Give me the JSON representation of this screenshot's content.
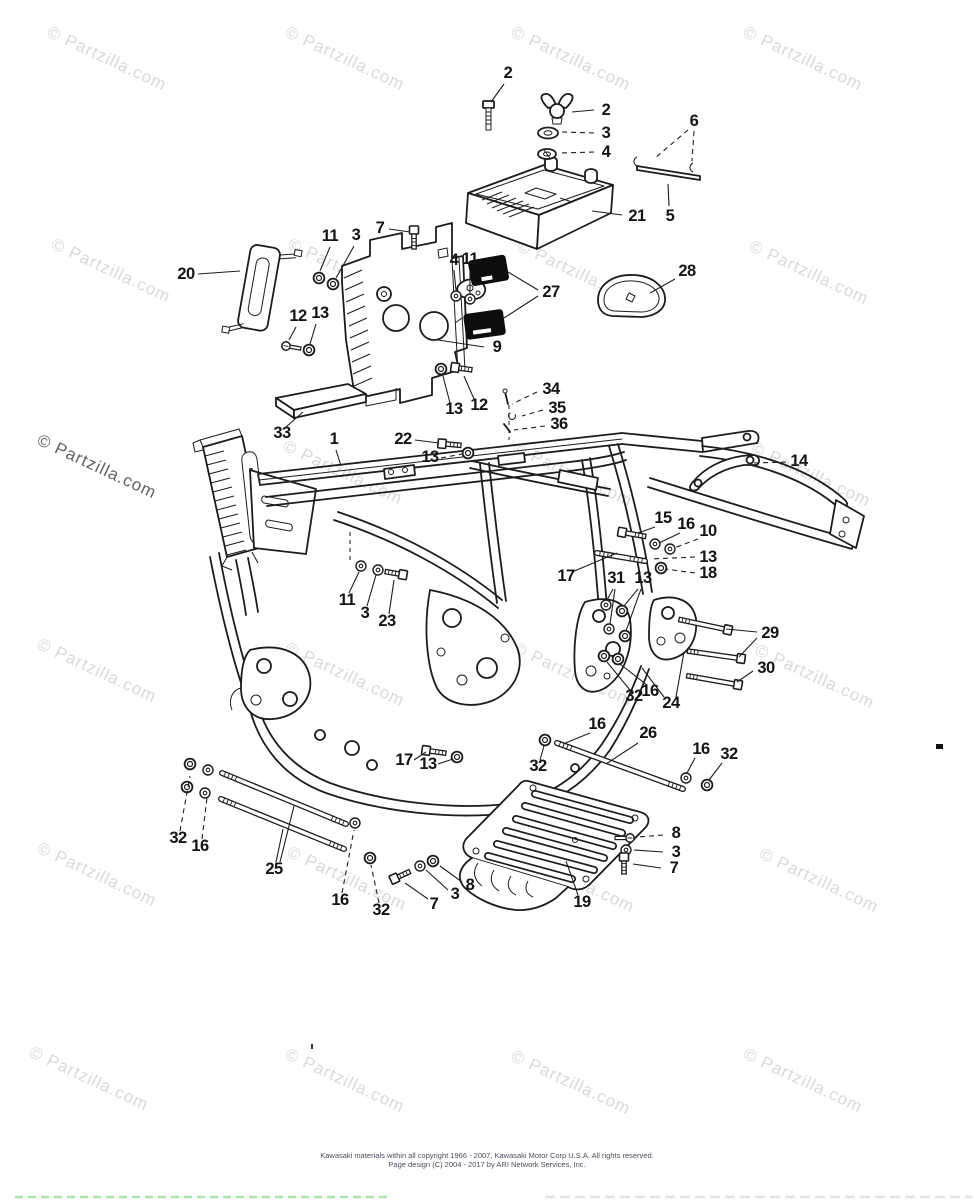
{
  "watermark": {
    "text": "© Partzilla.com",
    "angle": 25,
    "font_size": 17,
    "color_light": "#d6dcd4",
    "color_dark": "#636363",
    "positions": [
      {
        "x": 46,
        "y": 36
      },
      {
        "x": 284,
        "y": 36
      },
      {
        "x": 510,
        "y": 36
      },
      {
        "x": 742,
        "y": 36
      },
      {
        "x": 50,
        "y": 248
      },
      {
        "x": 287,
        "y": 248
      },
      {
        "x": 516,
        "y": 250
      },
      {
        "x": 748,
        "y": 250
      },
      {
        "x": 36,
        "y": 444,
        "dark": true
      },
      {
        "x": 282,
        "y": 450
      },
      {
        "x": 512,
        "y": 452
      },
      {
        "x": 750,
        "y": 452
      },
      {
        "x": 36,
        "y": 648
      },
      {
        "x": 284,
        "y": 652
      },
      {
        "x": 512,
        "y": 652
      },
      {
        "x": 754,
        "y": 654
      },
      {
        "x": 36,
        "y": 852
      },
      {
        "x": 286,
        "y": 856
      },
      {
        "x": 514,
        "y": 858
      },
      {
        "x": 758,
        "y": 858
      },
      {
        "x": 28,
        "y": 1056
      },
      {
        "x": 284,
        "y": 1058
      },
      {
        "x": 510,
        "y": 1060
      },
      {
        "x": 742,
        "y": 1058
      }
    ]
  },
  "footer": {
    "line1": "Kawasaki materials within all copyright 1966 - 2007, Kawasaki Motor Corp U.S.A.   All rights reserved.",
    "line2": "Page design (C) 2004 - 2017 by ARI Network Services, Inc."
  },
  "diagram": {
    "callouts": [
      {
        "n": "2",
        "x": 508,
        "y": 78,
        "leads": [
          [
            504,
            84,
            491,
            102,
            0
          ]
        ]
      },
      {
        "n": "2",
        "x": 606,
        "y": 115,
        "leads": [
          [
            594,
            110,
            572,
            112,
            0
          ]
        ]
      },
      {
        "n": "3",
        "x": 606,
        "y": 138,
        "leads": [
          [
            594,
            133,
            562,
            132,
            1
          ]
        ]
      },
      {
        "n": "4",
        "x": 606,
        "y": 157,
        "leads": [
          [
            594,
            152,
            560,
            153,
            1
          ]
        ]
      },
      {
        "n": "6",
        "x": 694,
        "y": 126,
        "leads": [
          [
            688,
            130,
            655,
            158,
            1
          ],
          [
            694,
            131,
            692,
            161,
            1
          ]
        ]
      },
      {
        "n": "21",
        "x": 637,
        "y": 221,
        "leads": [
          [
            622,
            215,
            592,
            211,
            0
          ]
        ]
      },
      {
        "n": "5",
        "x": 670,
        "y": 221,
        "leads": [
          [
            669,
            206,
            668,
            184,
            0
          ]
        ]
      },
      {
        "n": "11",
        "x": 330,
        "y": 241,
        "leads": [
          [
            330,
            247,
            320,
            271,
            0
          ]
        ]
      },
      {
        "n": "3",
        "x": 356,
        "y": 240,
        "leads": [
          [
            354,
            246,
            336,
            278,
            0
          ]
        ]
      },
      {
        "n": "7",
        "x": 380,
        "y": 233,
        "leads": [
          [
            389,
            229,
            410,
            232,
            0
          ]
        ]
      },
      {
        "n": "20",
        "x": 186,
        "y": 279,
        "leads": [
          [
            198,
            274,
            240,
            271,
            0
          ]
        ]
      },
      {
        "n": "4",
        "x": 454,
        "y": 265,
        "leads": [
          [
            454,
            270,
            456,
            290,
            0
          ]
        ]
      },
      {
        "n": "11",
        "x": 470,
        "y": 264,
        "leads": [
          [
            470,
            270,
            470,
            293,
            0
          ]
        ]
      },
      {
        "n": "27",
        "x": 551,
        "y": 297,
        "leads": [
          [
            538,
            290,
            508,
            272,
            0
          ],
          [
            538,
            296,
            504,
            318,
            0
          ]
        ]
      },
      {
        "n": "28",
        "x": 687,
        "y": 276,
        "leads": [
          [
            675,
            279,
            650,
            293,
            0
          ]
        ]
      },
      {
        "n": "12",
        "x": 298,
        "y": 321,
        "leads": [
          [
            296,
            327,
            289,
            340,
            0
          ]
        ]
      },
      {
        "n": "13",
        "x": 320,
        "y": 318,
        "leads": [
          [
            316,
            324,
            310,
            344,
            0
          ]
        ]
      },
      {
        "n": "9",
        "x": 497,
        "y": 352,
        "leads": [
          [
            484,
            347,
            438,
            340,
            0
          ]
        ]
      },
      {
        "n": "13",
        "x": 454,
        "y": 414,
        "leads": [
          [
            450,
            403,
            443,
            376,
            0
          ]
        ]
      },
      {
        "n": "12",
        "x": 479,
        "y": 410,
        "leads": [
          [
            474,
            399,
            464,
            376,
            0
          ]
        ]
      },
      {
        "n": "34",
        "x": 551,
        "y": 394,
        "leads": [
          [
            537,
            392,
            512,
            404,
            1
          ]
        ]
      },
      {
        "n": "35",
        "x": 557,
        "y": 413,
        "leads": [
          [
            543,
            410,
            522,
            416,
            1
          ]
        ]
      },
      {
        "n": "36",
        "x": 559,
        "y": 429,
        "leads": [
          [
            545,
            426,
            514,
            430,
            1
          ]
        ]
      },
      {
        "n": "33",
        "x": 282,
        "y": 438,
        "leads": [
          [
            286,
            427,
            303,
            412,
            0
          ]
        ]
      },
      {
        "n": "1",
        "x": 334,
        "y": 444,
        "leads": [
          [
            336,
            450,
            341,
            466,
            0
          ]
        ]
      },
      {
        "n": "22",
        "x": 403,
        "y": 444,
        "leads": [
          [
            415,
            440,
            439,
            443,
            0
          ]
        ]
      },
      {
        "n": "13",
        "x": 430,
        "y": 462,
        "leads": [
          [
            441,
            458,
            462,
            454,
            1
          ]
        ]
      },
      {
        "n": "14",
        "x": 799,
        "y": 466,
        "leads": [
          [
            786,
            462,
            754,
            463,
            1
          ]
        ]
      },
      {
        "n": "15",
        "x": 663,
        "y": 523,
        "leads": [
          [
            655,
            527,
            638,
            533,
            0
          ]
        ]
      },
      {
        "n": "16",
        "x": 686,
        "y": 529,
        "leads": [
          [
            680,
            533,
            659,
            543,
            0
          ]
        ]
      },
      {
        "n": "10",
        "x": 708,
        "y": 536,
        "leads": [
          [
            698,
            539,
            674,
            548,
            1
          ]
        ]
      },
      {
        "n": "13",
        "x": 708,
        "y": 562,
        "leads": [
          [
            695,
            557,
            650,
            559,
            1
          ]
        ]
      },
      {
        "n": "18",
        "x": 708,
        "y": 578,
        "leads": [
          [
            695,
            573,
            665,
            569,
            1
          ]
        ]
      },
      {
        "n": "17",
        "x": 566,
        "y": 581,
        "leads": [
          [
            572,
            572,
            617,
            553,
            0
          ]
        ]
      },
      {
        "n": "31",
        "x": 616,
        "y": 583,
        "leads": [
          [
            613,
            589,
            607,
            600,
            0
          ],
          [
            615,
            589,
            610,
            624,
            0
          ]
        ]
      },
      {
        "n": "13",
        "x": 643,
        "y": 583,
        "leads": [
          [
            638,
            589,
            624,
            606,
            0
          ],
          [
            641,
            589,
            626,
            631,
            0
          ]
        ]
      },
      {
        "n": "29",
        "x": 770,
        "y": 638,
        "leads": [
          [
            757,
            632,
            726,
            629,
            0
          ],
          [
            757,
            638,
            739,
            657,
            0
          ]
        ]
      },
      {
        "n": "30",
        "x": 766,
        "y": 673,
        "leads": [
          [
            753,
            671,
            737,
            682,
            0
          ]
        ]
      },
      {
        "n": "32",
        "x": 634,
        "y": 701,
        "leads": [
          [
            630,
            690,
            607,
            662,
            0
          ]
        ]
      },
      {
        "n": "16",
        "x": 650,
        "y": 696,
        "leads": [
          [
            647,
            685,
            620,
            664,
            0
          ]
        ]
      },
      {
        "n": "24",
        "x": 671,
        "y": 708,
        "leads": [
          [
            664,
            697,
            642,
            668,
            0
          ],
          [
            676,
            697,
            684,
            652,
            0
          ]
        ]
      },
      {
        "n": "16",
        "x": 597,
        "y": 729,
        "leads": [
          [
            590,
            733,
            563,
            744,
            0
          ]
        ]
      },
      {
        "n": "26",
        "x": 648,
        "y": 738,
        "leads": [
          [
            638,
            743,
            606,
            764,
            0
          ]
        ]
      },
      {
        "n": "16",
        "x": 701,
        "y": 754,
        "leads": [
          [
            695,
            758,
            687,
            773,
            0
          ]
        ]
      },
      {
        "n": "32",
        "x": 729,
        "y": 759,
        "leads": [
          [
            722,
            763,
            709,
            780,
            0
          ]
        ]
      },
      {
        "n": "17",
        "x": 404,
        "y": 765,
        "leads": [
          [
            414,
            760,
            426,
            752,
            0
          ]
        ]
      },
      {
        "n": "13",
        "x": 428,
        "y": 769,
        "leads": [
          [
            438,
            764,
            453,
            759,
            0
          ]
        ]
      },
      {
        "n": "32",
        "x": 538,
        "y": 771,
        "leads": [
          [
            540,
            760,
            544,
            746,
            0
          ]
        ]
      },
      {
        "n": "32",
        "x": 178,
        "y": 843,
        "leads": [
          [
            180,
            831,
            190,
            776,
            1
          ]
        ]
      },
      {
        "n": "16",
        "x": 200,
        "y": 851,
        "leads": [
          [
            202,
            839,
            207,
            798,
            1
          ]
        ]
      },
      {
        "n": "25",
        "x": 274,
        "y": 874,
        "leads": [
          [
            276,
            862,
            283,
            829,
            0
          ],
          [
            280,
            862,
            294,
            806,
            0
          ]
        ]
      },
      {
        "n": "16",
        "x": 340,
        "y": 905,
        "leads": [
          [
            342,
            893,
            354,
            830,
            1
          ]
        ]
      },
      {
        "n": "32",
        "x": 381,
        "y": 915,
        "leads": [
          [
            379,
            903,
            371,
            865,
            1
          ]
        ]
      },
      {
        "n": "7",
        "x": 434,
        "y": 909,
        "leads": [
          [
            428,
            899,
            405,
            883,
            0
          ]
        ]
      },
      {
        "n": "3",
        "x": 455,
        "y": 899,
        "leads": [
          [
            448,
            890,
            426,
            870,
            0
          ]
        ]
      },
      {
        "n": "8",
        "x": 470,
        "y": 890,
        "leads": [
          [
            462,
            882,
            440,
            866,
            0
          ]
        ]
      },
      {
        "n": "19",
        "x": 582,
        "y": 907,
        "leads": [
          [
            578,
            895,
            566,
            861,
            0
          ]
        ]
      },
      {
        "n": "8",
        "x": 676,
        "y": 838,
        "leads": [
          [
            663,
            835,
            638,
            837,
            1
          ]
        ]
      },
      {
        "n": "3",
        "x": 676,
        "y": 857,
        "leads": [
          [
            663,
            852,
            634,
            850,
            0
          ]
        ]
      },
      {
        "n": "7",
        "x": 674,
        "y": 873,
        "leads": [
          [
            661,
            868,
            633,
            864,
            0
          ]
        ]
      },
      {
        "n": "11",
        "x": 347,
        "y": 605,
        "leads": [
          [
            349,
            593,
            359,
            572,
            0
          ]
        ]
      },
      {
        "n": "3",
        "x": 365,
        "y": 618,
        "leads": [
          [
            367,
            606,
            376,
            575,
            0
          ]
        ]
      },
      {
        "n": "23",
        "x": 387,
        "y": 626,
        "leads": [
          [
            389,
            614,
            394,
            580,
            0
          ]
        ]
      }
    ],
    "fasteners": [
      {
        "t": "nut",
        "x": 319,
        "y": 278
      },
      {
        "t": "nut",
        "x": 333,
        "y": 284
      },
      {
        "t": "boltH",
        "x": 414,
        "y": 234,
        "len": 15,
        "a": 90
      },
      {
        "t": "washer",
        "x": 456,
        "y": 296
      },
      {
        "t": "washer",
        "x": 470,
        "y": 299
      },
      {
        "t": "screwH",
        "x": 286,
        "y": 346,
        "len": 11,
        "a": 10
      },
      {
        "t": "nut",
        "x": 309,
        "y": 350
      },
      {
        "t": "nut",
        "x": 441,
        "y": 369
      },
      {
        "t": "boltH",
        "x": 459,
        "y": 368,
        "len": 13,
        "a": 8
      },
      {
        "t": "boltH",
        "x": 446,
        "y": 444,
        "len": 15,
        "a": 5
      },
      {
        "t": "nut",
        "x": 468,
        "y": 453
      },
      {
        "t": "washer",
        "x": 361,
        "y": 566
      },
      {
        "t": "washer",
        "x": 378,
        "y": 570
      },
      {
        "t": "boltH",
        "x": 399,
        "y": 574,
        "len": 14,
        "a": 190
      },
      {
        "t": "boltH",
        "x": 626,
        "y": 533,
        "len": 20,
        "a": 10
      },
      {
        "t": "washer",
        "x": 655,
        "y": 544
      },
      {
        "t": "washer",
        "x": 670,
        "y": 549
      },
      {
        "t": "stud",
        "x1": 597,
        "y1": 553,
        "x2": 645,
        "y2": 561
      },
      {
        "t": "nut",
        "x": 661,
        "y": 568
      },
      {
        "t": "washer",
        "x": 606,
        "y": 605
      },
      {
        "t": "nut",
        "x": 622,
        "y": 611
      },
      {
        "t": "washer",
        "x": 609,
        "y": 629
      },
      {
        "t": "nut",
        "x": 625,
        "y": 636
      },
      {
        "t": "nut",
        "x": 604,
        "y": 656
      },
      {
        "t": "nut",
        "x": 618,
        "y": 659
      },
      {
        "t": "boltH",
        "x": 724,
        "y": 629,
        "len": 46,
        "a": 192
      },
      {
        "t": "boltH",
        "x": 737,
        "y": 658,
        "len": 50,
        "a": 188
      },
      {
        "t": "boltH",
        "x": 734,
        "y": 684,
        "len": 48,
        "a": 190
      },
      {
        "t": "nut",
        "x": 545,
        "y": 740
      },
      {
        "t": "stud",
        "x1": 557,
        "y1": 743,
        "x2": 683,
        "y2": 789
      },
      {
        "t": "washer",
        "x": 686,
        "y": 778
      },
      {
        "t": "nut",
        "x": 707,
        "y": 785
      },
      {
        "t": "boltH",
        "x": 430,
        "y": 751,
        "len": 16,
        "a": 8
      },
      {
        "t": "nut",
        "x": 457,
        "y": 757
      },
      {
        "t": "nut",
        "x": 190,
        "y": 764
      },
      {
        "t": "washer",
        "x": 208,
        "y": 770
      },
      {
        "t": "nut",
        "x": 187,
        "y": 787
      },
      {
        "t": "washer",
        "x": 205,
        "y": 793
      },
      {
        "t": "stud",
        "x1": 222,
        "y1": 773,
        "x2": 346,
        "y2": 824
      },
      {
        "t": "stud",
        "x1": 221,
        "y1": 799,
        "x2": 344,
        "y2": 849
      },
      {
        "t": "washer",
        "x": 355,
        "y": 823
      },
      {
        "t": "nut",
        "x": 370,
        "y": 858
      },
      {
        "t": "boltH",
        "x": 398,
        "y": 877,
        "len": 13,
        "a": -25
      },
      {
        "t": "washer",
        "x": 420,
        "y": 866
      },
      {
        "t": "nut",
        "x": 433,
        "y": 861
      },
      {
        "t": "screwH",
        "x": 630,
        "y": 838,
        "len": 11,
        "a": 180
      },
      {
        "t": "washer",
        "x": 626,
        "y": 850
      },
      {
        "t": "boltH",
        "x": 624,
        "y": 861,
        "len": 13,
        "a": 90
      }
    ]
  }
}
